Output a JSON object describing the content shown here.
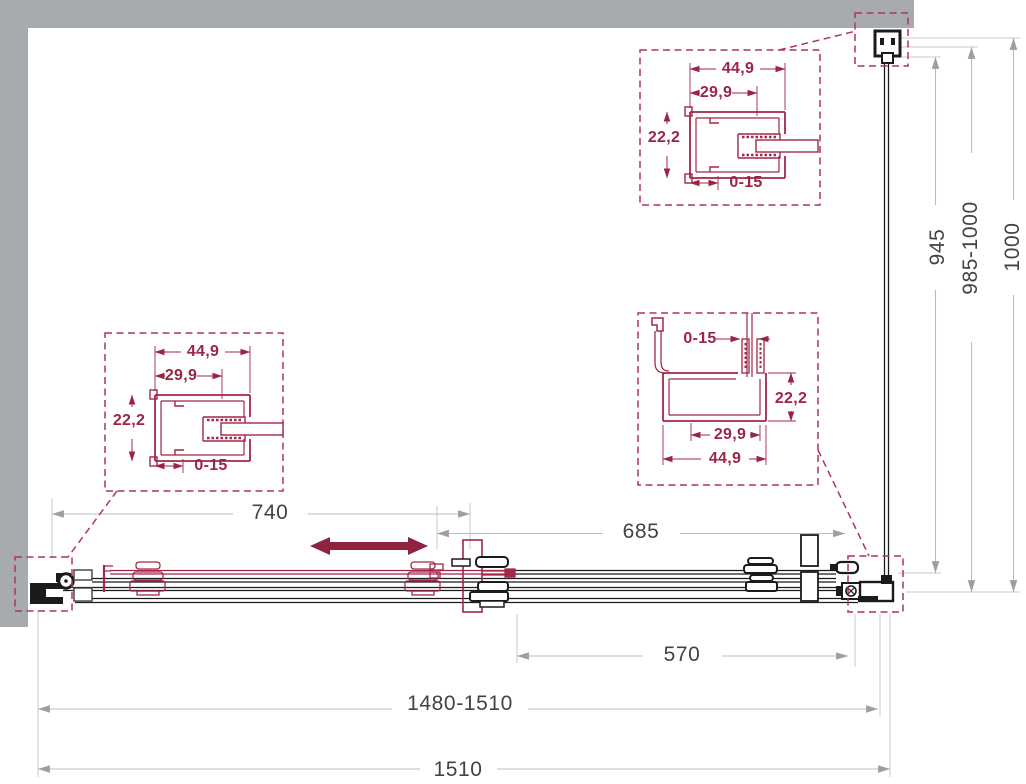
{
  "drawing": {
    "type": "shower-enclosure-plan-technical-drawing",
    "colors": {
      "accent_red": "#9c2444",
      "line_black": "#1b1b1d",
      "dim_gray": "#b9bdc0",
      "wall_gray": "#a8abad",
      "text_dark": "#3f4447"
    },
    "dims": {
      "door_width": "740",
      "fixed_section_width": "685",
      "side_section_width": "570",
      "adjustable_total_width": "1480-1510",
      "total_width": "1510",
      "side_panel_depth": "945",
      "side_adjustable_depth": "985-1000",
      "side_total_depth": "1000"
    },
    "detail_left": {
      "outer_width": "44,9",
      "inner_width": "29,9",
      "height": "22,2",
      "adjustment": "0-15"
    },
    "detail_top": {
      "outer_width": "44,9",
      "inner_width": "29,9",
      "height": "22,2",
      "adjustment": "0-15"
    },
    "detail_corner": {
      "adjustment": "0-15",
      "height": "22,2",
      "inner_width": "29,9",
      "outer_width": "44,9"
    }
  }
}
